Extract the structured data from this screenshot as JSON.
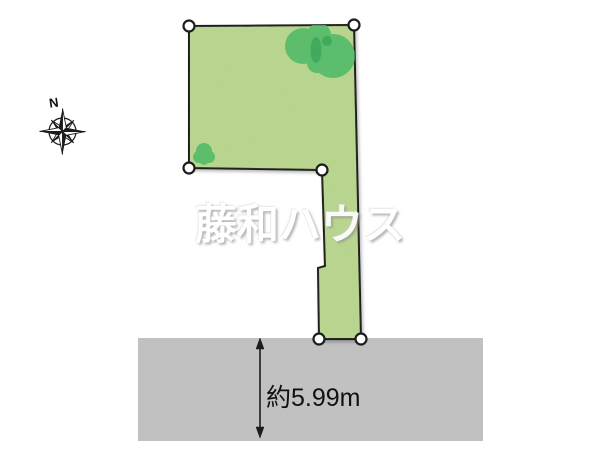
{
  "diagram": {
    "watermark_text": "藤和ハウス",
    "compass_north_label": "N",
    "frontage_dimension_label": "約5.99m"
  },
  "icons": {
    "compass": "compass-rose-icon",
    "trees": "tree-icon"
  },
  "colors": {
    "parcel-fill": "#b9d58e",
    "parcel-outline": "#1c1c1c",
    "tree-green": "#5cbd6c",
    "tree-dark": "#41aa5d",
    "road-gray": "#c1c1c1",
    "marker-fill": "#ffffff",
    "label-text": "#111111",
    "watermark-white": "#ffffff"
  }
}
